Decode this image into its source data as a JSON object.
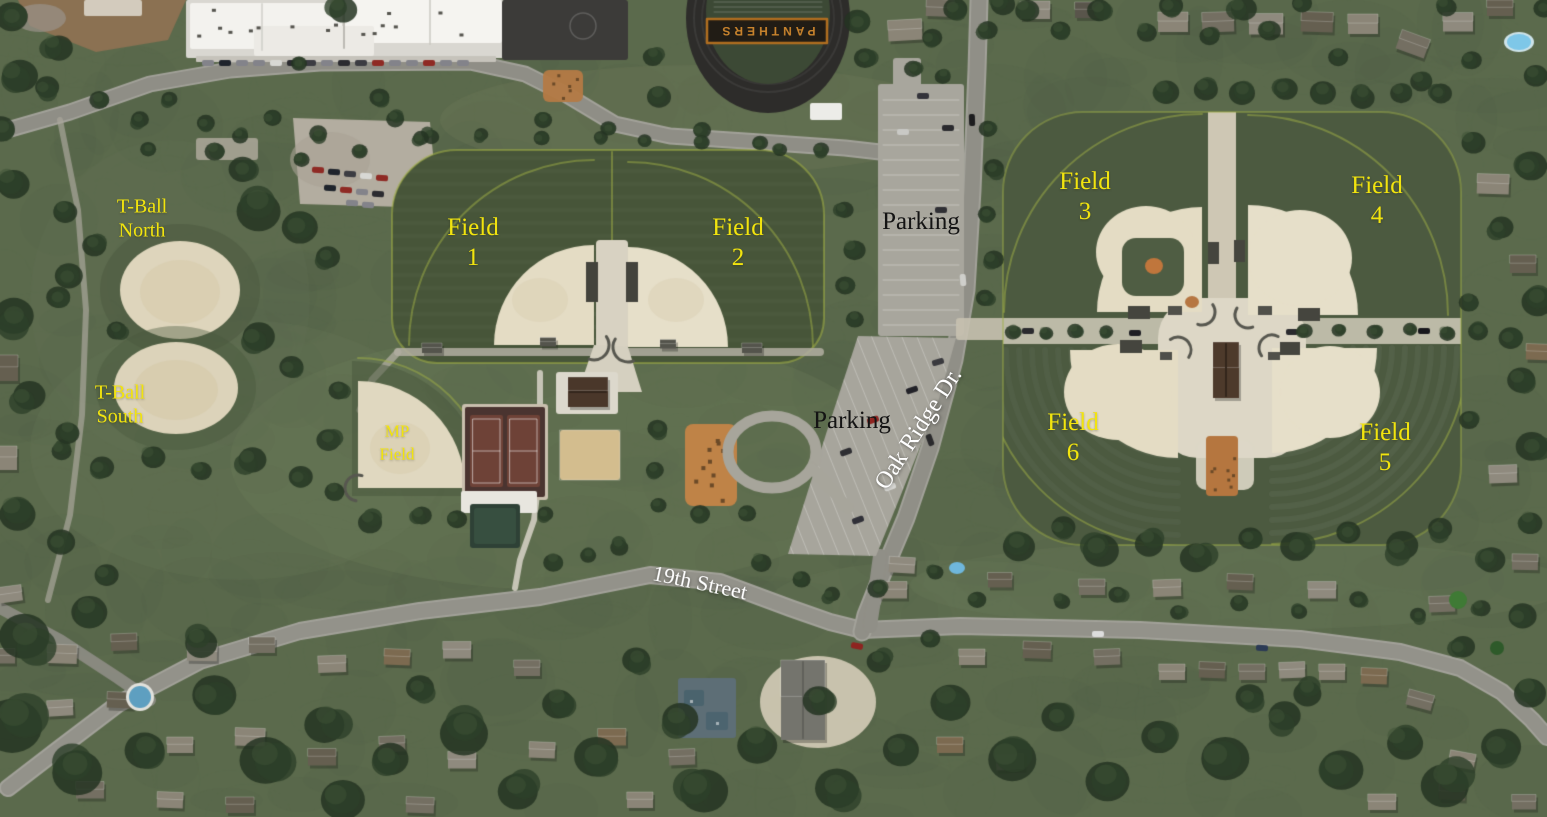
{
  "map": {
    "field_labels": [
      {
        "id": "t-ball-north",
        "lines": [
          "T-Ball",
          "North"
        ]
      },
      {
        "id": "t-ball-south",
        "lines": [
          "T-Ball",
          "South"
        ]
      },
      {
        "id": "field-1",
        "lines": [
          "Field",
          "1"
        ]
      },
      {
        "id": "field-2",
        "lines": [
          "Field",
          "2"
        ]
      },
      {
        "id": "mp-field",
        "lines": [
          "MP",
          "Field"
        ]
      },
      {
        "id": "field-3",
        "lines": [
          "Field",
          "3"
        ]
      },
      {
        "id": "field-4",
        "lines": [
          "Field",
          "4"
        ]
      },
      {
        "id": "field-5",
        "lines": [
          "Field",
          "5"
        ]
      },
      {
        "id": "field-6",
        "lines": [
          "Field",
          "6"
        ]
      }
    ],
    "parking_labels": [
      {
        "id": "parking-north",
        "text": "Parking"
      },
      {
        "id": "parking-south",
        "text": "Parking"
      }
    ],
    "road_labels": [
      {
        "id": "oak-ridge-dr",
        "text": "Oak Ridge Dr."
      },
      {
        "id": "nineteenth-street",
        "text": "19th Street"
      }
    ],
    "stadium_text": "PANTHERS",
    "colors": {
      "field_label": "#f2e40e",
      "parking_label": "#141414",
      "road_label": "#ffffff",
      "stadium_text": "#c8832d"
    }
  }
}
